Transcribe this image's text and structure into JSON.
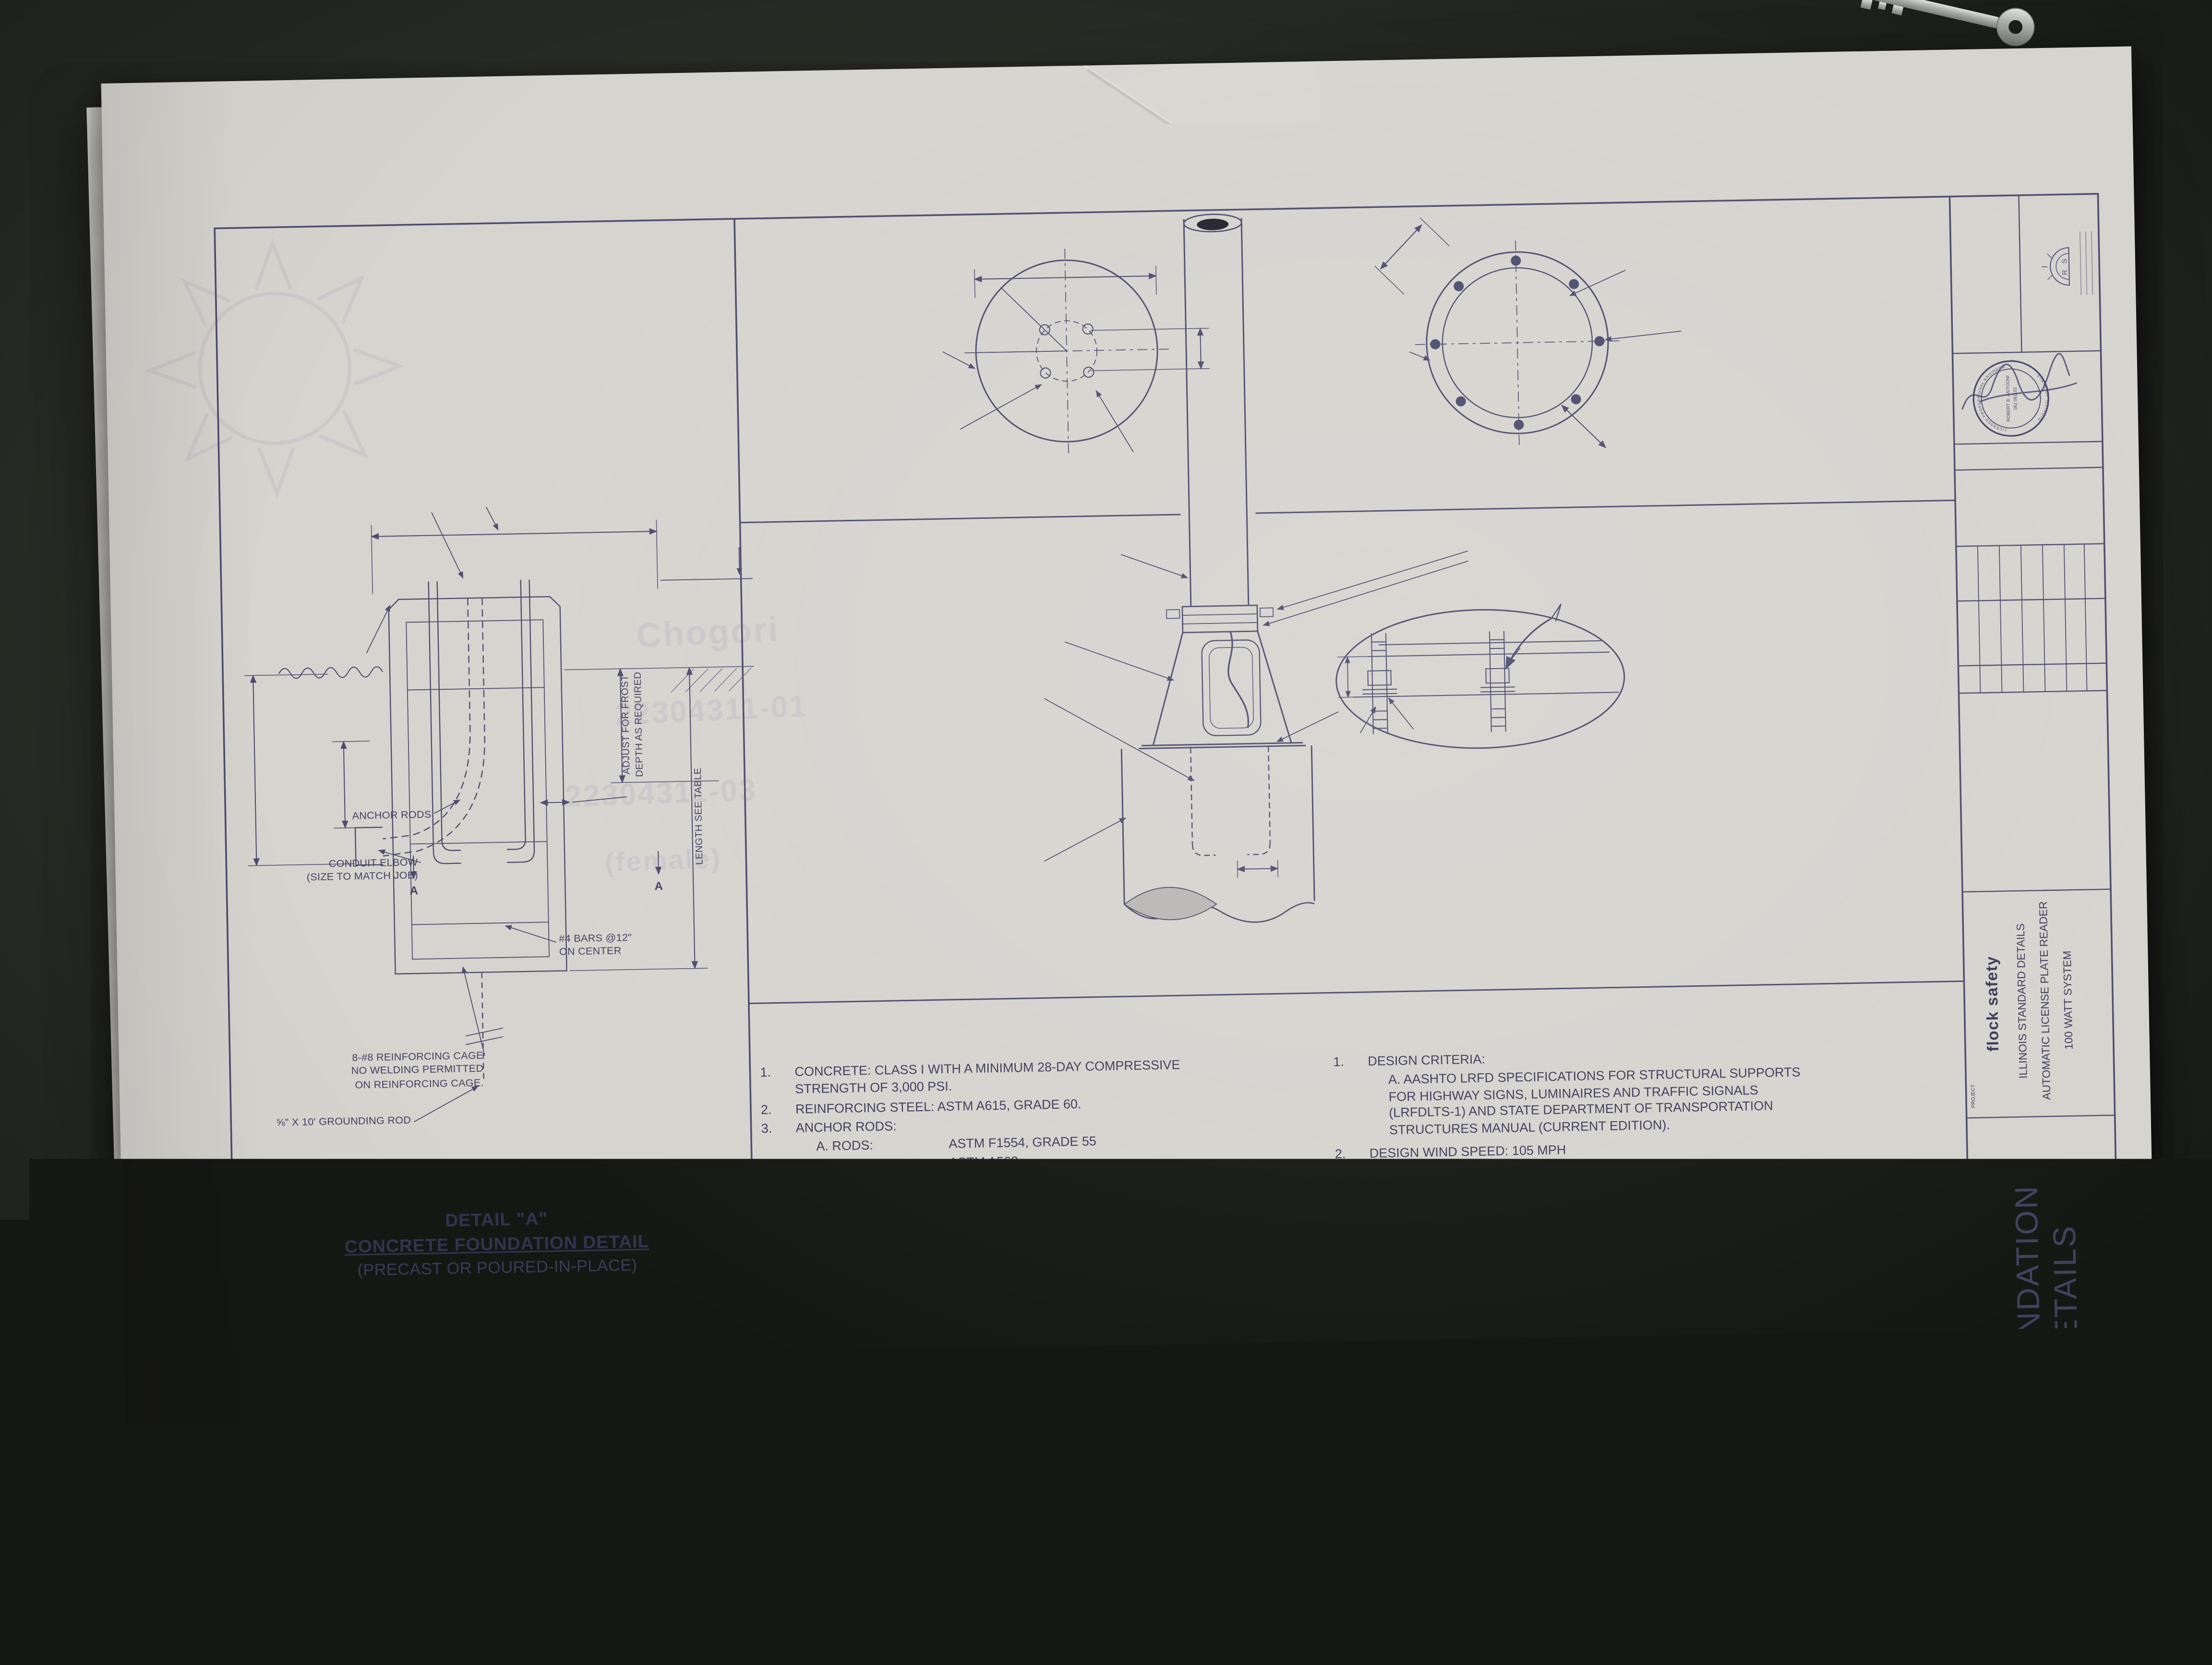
{
  "detail": {
    "bond_wire": "#6 AWG BARE BOND\nWIRE TO BE CLAMPED TO\nGROUND ROD",
    "diameter": "DIAMETER\nSEE TABLE",
    "projection": "4.13\" PROJECTION",
    "chamfer": "1\" CHAMFER",
    "dim24": "24\"",
    "conduit_depth": "CONDUIT DEPTH",
    "dim12": "12\"",
    "clear3": "3\" CLEAR",
    "anchor_rods": "ANCHOR RODS",
    "conduit_elbow": "CONDUIT ELBOW\n(SIZE TO MATCH JOB)",
    "cage": "8-#8 REINFORCING CAGE\nNO WELDING PERMITTED\nON REINFORCING CAGE.",
    "bars": "#4 BARS @12\"\nON CENTER",
    "grounding_rod": "⅝\" X 10' GROUNDING ROD",
    "frost": "ADJUST FOR FROST\nDEPTH AS REQUIRED",
    "length": "LENGTH SEE TABLE",
    "marker_a": "A",
    "title": "DETAIL \"A\"",
    "subtitle": "CONCRETE FOUNDATION DETAIL",
    "subtitle2": "(PRECAST OR POURED-IN-PLACE)"
  },
  "top_view": {
    "see_table": "SEE TABLE",
    "pole": "℄ POLE",
    "typ45": "45°\nTYP.",
    "bolt_circle": "6\" BOLT CIRCLE",
    "typ2": "2\"",
    "typ2b": "TYP.\nEACH WAY",
    "anchor_note": "4 - EQUALLY SPACED\nANCHOR RODS ORIENTED\nAS SHOWN WHEN THE\nSHAFT IS INSTALLED.",
    "title": "TOP VIEW"
  },
  "section": {
    "lap": "12\"\nLAP",
    "pole": "℄ POLE",
    "tie": "#4 TIE BAR @12\"\nCENTERS * (MAX.)",
    "bars": "8-#8 BARS\nEQUALLY SPACED",
    "clear": "3\" CLEAR\n(MIN.)",
    "title": "SECTION A-A"
  },
  "base": {
    "pole": "12'-4.5\" SCHEDULE 40\n6061-T6 ALUMINUM POLE",
    "set_screws": "(2) ⅜\" SET SCREWS OR\nCABLE TETHER BOLT SET",
    "alum_base": "ALUMINUM BASE\nMASH CP6 SERIES",
    "anchor_bolts": "(4) ANCHOR BOLTS\nSEE TABLE FOR SIZE",
    "tether": "CABLE TETHER*\n(OPTIONAL)",
    "washer": "WASHER",
    "nut": "NUT",
    "dim413": "4.13\"",
    "foundation": "FOUNDATION\nSEE TABLE FOR SIZE",
    "dim4": "4\"",
    "tether_note": "* CABLE TETHER (CT) RECOMMENDED\nFOR ASSEMBLIES 10' OR LESS",
    "title": "BASE MOUNTING DETAIL"
  },
  "notes": {
    "title": "FOUNDATION NOTES:",
    "n1num": "1.",
    "n1": "CONCRETE:    CLASS I WITH A MINIMUM 28-DAY COMPRESSIVE STRENGTH OF 3,000 PSI.",
    "n2num": "2.",
    "n2": "REINFORCING STEEL:   ASTM A615, GRADE 60.",
    "n3num": "3.",
    "n3": "ANCHOR RODS:",
    "n3a_k": "A. RODS:",
    "n3a_v": "ASTM F1554, GRADE 55",
    "n3b_k": "B. NUTS:",
    "n3b_v": "ASTM A563",
    "n3c_k": "C. WASHERS:",
    "n3c_v": "ASTM F436",
    "n3d": "D. GALVANIZE ALL ITEMS IN ACCORDANCE WITH ASTM F2329.",
    "n4num": "4.",
    "n4": "FOR PRECAST CONCRETE FOUNDATIONS, FILL THE VOID AROUND THE FOUNDATION WITH FLOWABLE FILL OR CLEAN SANDS USING HYDRAULIC METHODS TO A LEVEL 6 INCHES BELOW GRADE.",
    "n5num": "5.",
    "n5": "AFTER THE POLE IS SET IN FINAL POSITION AND ALIGNMENT, APPLY A COAT OF ZINC-RICH PAINT TO THE ANCHOR ROD THREADS AND NUTS TO SEAL THE JOINT BETWEEN THE NUT AND ANCHOR ROD.",
    "n6num": "6.",
    "n6": "WHERE FOUNDATION ABUTS THE SIDEWALK, THE TOP OF THE FOUNDATION SHALL BE LEVEL WITH THE SIDEWALK. FOR ALL OTHER CASES, THE TOP OF THE FOUNDATION SHALL NOT BE MORE THAN 3 INCHES ABOVE GRADE."
  },
  "design": {
    "title": "FOUNDATION DESIGN NOTES:",
    "n1num": "1.",
    "n1": "DESIGN CRITERIA:",
    "n1a": "A. AASHTO LRFD SPECIFICATIONS FOR STRUCTURAL SUPPORTS FOR HIGHWAY SIGNS, LUMINAIRES AND TRAFFIC SIGNALS (LRFDLTS-1) AND STATE DEPARTMENT OF TRANSPORTATION STRUCTURES MANUAL (CURRENT EDITION).",
    "n2num": "2.",
    "n2": "DESIGN WIND SPEED: 105 MPH",
    "n3num": "3.",
    "n3": "THE FOLLOWING SOIL PROPERTIES WERE ASSUMED FOR THE FOUNDATION DESIGN. IF THE ENCOUNTERED SOIL CONDITIONS DO NOT MEET THESE ASSUMED SOIL PARAMETERS, THEN A SPECIAL FOUNDATION MUST BE DESIGNED.",
    "n3a_k": "A. SUBMERGED UNIT WEIGHT:",
    "n3a_v": "62.5 PCF",
    "n3b_k": "B. INTERNAL ANGLE OF FRICTION:",
    "n3b_v": "32 DEGREES"
  },
  "table": {
    "h_pole": "POLE\nTYPE",
    "h_wind": "WIND\nSPEED",
    "h_height": "POLE\nHEIGHT",
    "h_foundation": "FOUNDATION",
    "h_dia": "DIAMETER",
    "h_depth": "DEPTH",
    "h_bc": "BOLT CIRCLE (B.C.)",
    "h_reinf": "FOUNDATION REINFORCEMENT",
    "h_vert": "VERTICAL",
    "h_horiz": "HORIZONTAL",
    "h_anchor": "ANCHOR RODS",
    "h_adia": "DIA",
    "h_len": "LENGTH",
    "h_thread": "THREAD LENGTH (TOP)",
    "r_pole": "LPR POLE\nASSEMBLY",
    "r_wind": "105 MPH",
    "r_height": "12'",
    "r_dia": "1'-6\"",
    "r_depth": "* 4'-0\"",
    "r_bc": "6\"",
    "r_vert": "8 - NO .8",
    "r_horiz": "NO. 4 @ 12\" C-C",
    "r_adia": "5/8\"",
    "r_len": "16.00\"",
    "r_thread": "6\"",
    "footnote": "* MUST ALLOW FOR FROST DEPTH AS APPLICABLE BASED ON REGION OR LOCAL REQUIREMENTS."
  },
  "tb": {
    "contact_label": "CONTACT:",
    "brand": "flock safety",
    "reds": "REDS",
    "reds_r": "R",
    "reds_s": "S",
    "stamp_name": "ROBERT B. ZAITOONI",
    "stamp_no": "062.061102",
    "stamp_arc_top": "LICENSED PROFESSIONAL ENGINEER",
    "stamp_arc_bottom": "STATE OF ILLINOIS",
    "date_label": "DATE",
    "date_value": "10-01-21",
    "rev_h_delta": "DELTA",
    "rev_h_desc": "DESCRIPTION",
    "rev_h_date": "DATE",
    "rev_delta": "△",
    "rev_desc": "1ST SUBMITTAL",
    "rev_date": "10.01.2021",
    "project_label": "PROJECT",
    "project_brand": "flock safety",
    "project_l1": "ILLINOIS STANDARD DETAILS",
    "project_l2": "AUTOMATIC LICENSE PLATE READER",
    "project_l3": "100 WATT SYSTEM",
    "sheet_name_label": "SHEET NAME",
    "sheet_name": "FOUNDATION DETAILS",
    "sheet_no_label": "SHEET NUMBER",
    "sheet_no": "4",
    "sheet_of": "OF  4  SHEETS",
    "plot_stamp": "Oct 01, 2021 - 9:51am / FlockSafety ALPR 100W - IL Standards.dwg"
  },
  "ghost": {
    "g1a": "Chogori",
    "g1b": "22304311-01",
    "g2a": "22304311-03",
    "g2b": "(female)",
    "g3": "PS-15",
    "g4": "Charge Co"
  }
}
